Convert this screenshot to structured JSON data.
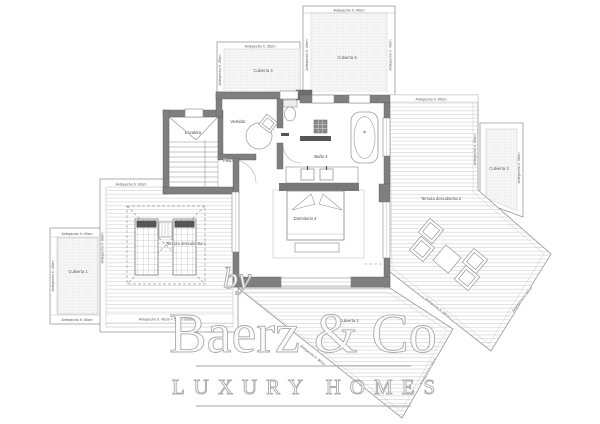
{
  "plan": {
    "type": "floor-plan",
    "rooms": {
      "escalera": "Escalera",
      "vestidor": "Vestidor",
      "paso": "Paso",
      "bano4": "Baño 4",
      "dormitorio4": "Dormitorio 4",
      "terraza1": "Terraza descubierta 1",
      "terraza2": "Terraza descubierta 2",
      "cubierta1": "Cubierta 1",
      "cubierta2": "Cubierta 2",
      "cubierta3": "Cubierta 3",
      "cubierta4": "Cubierta 4",
      "cubierta5": "Cubierta 5"
    },
    "dimension_labels": {
      "antepecho35": "Antepecho  h: 35cm",
      "antepecho40": "Antepecho  h: 40cm",
      "antepecho90": "Antepecho  h: 90cm",
      "antepecho4050": "Antepecho  h: 40cm + 50cm barandilla"
    },
    "colors": {
      "wall": "#7f7f7f",
      "outline": "#999999",
      "deck_line": "#d6d6d6",
      "label_text": "#4a4a4a",
      "watermark_stroke": "#ababab"
    }
  },
  "watermark": {
    "by": "by",
    "brand": "Baerz & Co",
    "tagline": "LUXURY HOMES"
  }
}
